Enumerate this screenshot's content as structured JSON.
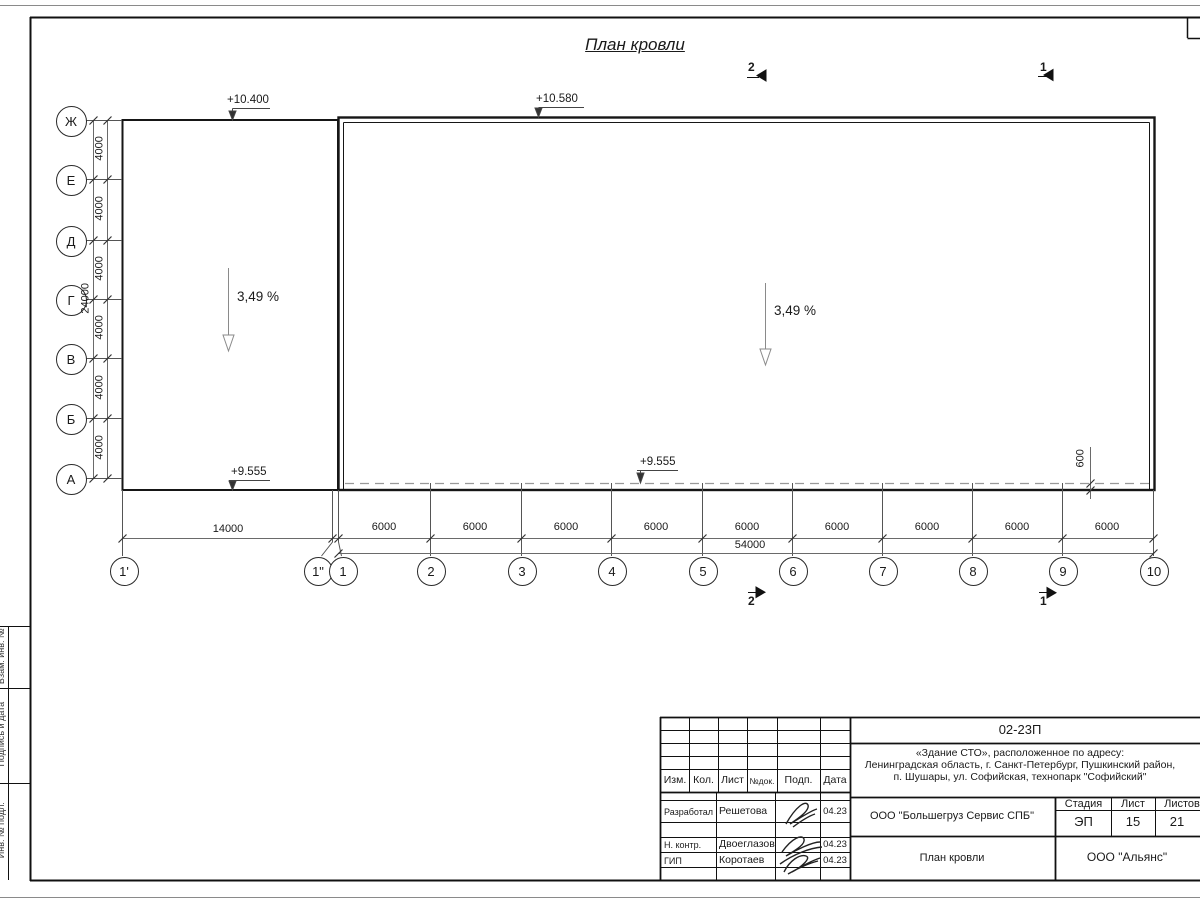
{
  "title": "План кровли",
  "axes": {
    "rows": [
      "Ж",
      "Е",
      "Д",
      "Г",
      "В",
      "Б",
      "А"
    ],
    "cols": [
      "1'",
      "1\"",
      "1",
      "2",
      "3",
      "4",
      "5",
      "6",
      "7",
      "8",
      "9",
      "10"
    ]
  },
  "dimensions": {
    "row_segments": [
      "4000",
      "4000",
      "4000",
      "4000",
      "4000",
      "4000"
    ],
    "row_total": "24000",
    "span_first": "14000",
    "col_segments": [
      "6000",
      "6000",
      "6000",
      "6000",
      "6000",
      "6000",
      "6000",
      "6000",
      "6000"
    ],
    "col_total": "54000",
    "eaves_offset": "600"
  },
  "elevations": {
    "left_top": "+10.400",
    "right_top": "+10.580",
    "left_bottom": "+9.555",
    "mid_bottom": "+9.555"
  },
  "slopes": {
    "left": "3,49 %",
    "right": "3,49 %"
  },
  "sections": {
    "top_left": "2",
    "top_right": "1",
    "bottom_left": "2",
    "bottom_right": "1"
  },
  "frame_labels": [
    "Взам. инв. №",
    "Подпись и дата",
    "Инв. № подл."
  ],
  "title_block": {
    "doc_number": "02-23П",
    "object_lines": [
      "«Здание СТО», расположенное по адресу:",
      "Ленинградская область, г. Санкт-Петербург, Пушкинский район,",
      "п. Шушары, ул. Софийская, технопарк \"Софийский\""
    ],
    "header_cols": [
      "Изм.",
      "Кол.",
      "Лист",
      "№док.",
      "Подп.",
      "Дата"
    ],
    "people": [
      {
        "role": "Разработал",
        "name": "Решетова",
        "date": "04.23"
      },
      {
        "role": "Н. контр.",
        "name": "Двоеглазов",
        "date": "04.23"
      },
      {
        "role": "ГИП",
        "name": "Коротаев",
        "date": "04.23"
      }
    ],
    "company": "ООО \"Большегруз Сервис СПБ\"",
    "sheet_title": "План кровли",
    "org": "ООО \"Альянс\"",
    "stage_label": "Стадия",
    "sheet_label": "Лист",
    "sheets_label": "Листов",
    "stage": "ЭП",
    "sheet": "15",
    "sheets": "21"
  }
}
